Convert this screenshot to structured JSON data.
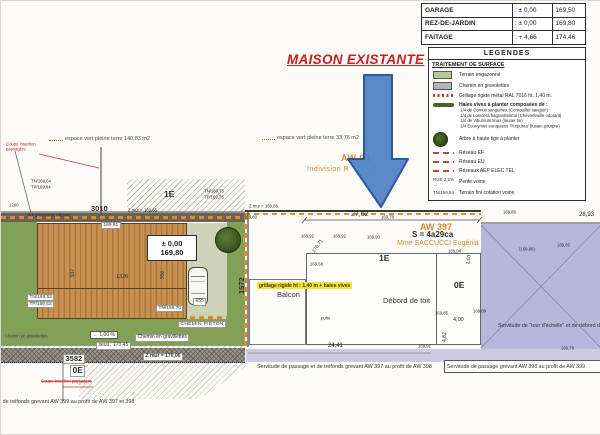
{
  "colors": {
    "title_red": "#c42020",
    "arrow_blue": "#4d82c4",
    "arrow_border": "#1e4d8f",
    "cadastre_orange": "#d4892e",
    "building_tan": "#c79050",
    "lavender": "#b8b6da",
    "hedge_orange": "#e08a28",
    "highlight_yellow": "#f2e23c",
    "legend_green": "#b7c79a"
  },
  "annotation": {
    "title": "MAISON EXISTANTE"
  },
  "elevation_table": {
    "rows": [
      {
        "label": "GARAGE",
        "relative": ": ± 0,00",
        "absolute": "169,50"
      },
      {
        "label": "REZ-DE-JARDIN",
        "relative": ": ± 0,00",
        "absolute": "169,80"
      },
      {
        "label": "FAITAGE",
        "relative": ": + 4,66",
        "absolute": "174,46"
      }
    ]
  },
  "legend": {
    "title": "LEGENDES",
    "section_title": "TRAITEMENT DE SURFACE",
    "items": [
      {
        "glyph": "green-swatch",
        "label": "Terrain engazonné"
      },
      {
        "glyph": "gray-swatch",
        "label": "Chemin en gravolettes"
      },
      {
        "glyph": "red-dotted-line",
        "label": "Grillage rigide métal RAL 7016 ht. 1,40 m."
      },
      {
        "glyph": "dark-green-bar",
        "label": "Haies vives à planter composées de :",
        "sublabels": [
          "1/4 de Cornus sanguinea (Cornouiller sanguin)",
          "1/4 de Lonicera fragrantissima (Chèvrefeuille odorant)",
          "1/4 de Viburnum tinus (laurier tin)",
          "1/4 Euonymus europaeus 'Purpurea' (fusain pourpre)"
        ]
      },
      {
        "glyph": "tree-circle",
        "label": "Arbre à haute tige à planter"
      },
      {
        "glyph": "red-dashes",
        "label": "Réseau EF"
      },
      {
        "glyph": "red-dashes",
        "label": "Réseau EU"
      },
      {
        "glyph": "red-dashes",
        "label": "Réseaux AEP ELEC TEL"
      },
      {
        "glyph": "slope-arrow",
        "glyph_text": "RUE 2,5% →",
        "label": "Pente voirie"
      },
      {
        "glyph": "tn-text",
        "glyph_text": "TN/169,64",
        "label": "Terrain fini cotation voirie"
      }
    ]
  },
  "plan": {
    "labels": {
      "espace_vert_left": "espace vert pleine terre 140,83 m2",
      "espace_vert_right": "espace vert pleine terre 33,76 m2",
      "coupe_insertion_top": "Coupe insertion paysagère",
      "coupe_insertion_bottom": "Coupe insertion paysagère",
      "aw94_number": "AW 94",
      "aw94_owner": "Indivision R",
      "aw94_owner_end": "T",
      "aw397_number": "AW 397",
      "aw397_area": "S = 4a29ca",
      "aw397_owner": "Mme SACCUCCI Eugénia",
      "point_1260": "1260",
      "point_3010": "3010",
      "point_1572": "1572",
      "point_3582": "3582",
      "point_655": "655",
      "floor_1e_left": "1E",
      "floor_1e_right": "1E",
      "floor_0e_left": "0E",
      "floor_0e_right": "0E",
      "tn_169_64": "TN/169,64",
      "tp_169_64": "TP/169,64",
      "tn_169_75": "TN/169,75",
      "tp_169_75": "TP/169,75",
      "tn_169_52": "TN/169,52",
      "tp_169_52": "TP/169,52",
      "tn_169_70": "TN/169,70",
      "mur_preexistant": "Mur préexistant mitoyen",
      "z_mur_169_85": "Z mur = 169,85",
      "z_mur_169_86": "Z mur = 169,86",
      "z_mur_170_06": "Z mur = 170,06",
      "level_pm_000": "± 0,00",
      "level_169_80": "169,80",
      "chip_169_91": "169,91",
      "dim_1326": "1326",
      "dim_950": "950",
      "dim_917": "917",
      "dim_27_62": "27,62",
      "dim_28_93": "28,93",
      "dim_24_41": "24,41",
      "dim_4_00": "4,00",
      "dim_4_82": "4,82",
      "dim_1_63": "1,63",
      "spot_169_80": "169,80",
      "spot_169_78": "169,78",
      "spot_169_92a": "169,92",
      "spot_169_92b": "169,92",
      "spot_169_93": "169,93",
      "spot_170_71": "170,71",
      "spot_169_68": "169,68",
      "spot_169_94": "169,94",
      "spot_169_86_lav": "169,86",
      "spot_169_90_paren": "(169,90)",
      "spot_169_85_lav": "169,85",
      "spot_169_85b": "169,85",
      "spot_169_89": "169,89",
      "spot_169_91b": "169,91",
      "spot_169_79": "169,79",
      "balcon": "Balcon",
      "debord_de_toit": "Débord de toit",
      "puits": "puits",
      "grillage_note": "grillage rigide ht : 1,40 m + haies vives",
      "servitude_tour_echelle": "Servitude de \"tour d'échelle\" et de débord de toit",
      "servitude_aw397": "Servitude de passage et de tréfonds grevant AW 397 au profit de AW 398",
      "servitude_aw398": "Servitude de passage grevant AW 398 au profit de AW 399",
      "servitude_aw399": "Servitude de passage et de tréfonds grevant AW 399 au profit de AW 397 et 398",
      "slope_1_pct": "← 1,00 %",
      "seuil_170_45": "seuil : 170,45",
      "chemin_gravillettes": "Chemin en gravillettes",
      "chemin_gravolettes": "Chemin en gravolettes",
      "chemin_pieton": "CHEMIN PIETON"
    }
  }
}
